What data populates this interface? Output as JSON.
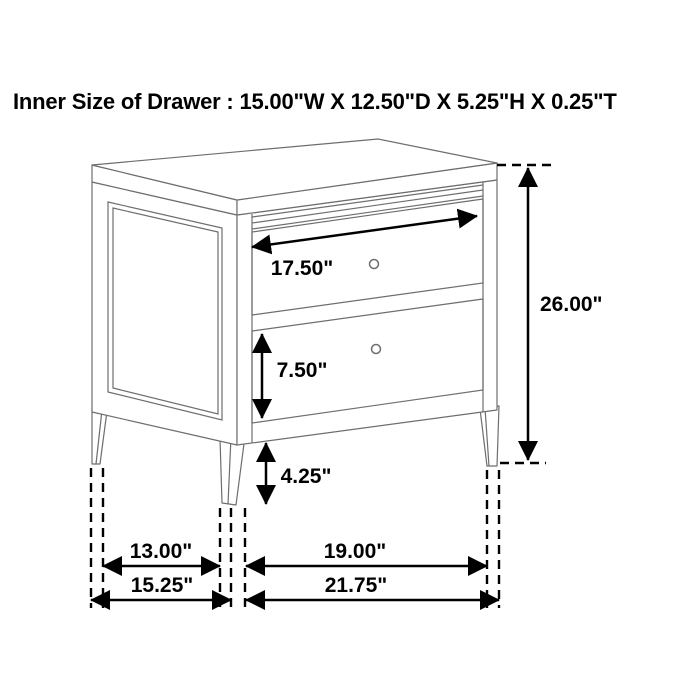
{
  "title": "Inner Size of Drawer : 15.00\"W X 12.50\"D X 5.25\"H X 0.25\"T",
  "dimensions": {
    "drawer_front_width": "17.50\"",
    "overall_height": "26.00\"",
    "bottom_drawer_height": "7.50\"",
    "leg_height": "4.25\"",
    "side_leg_span_inner": "13.00\"",
    "side_overall_depth": "15.25\"",
    "front_leg_span_inner": "19.00\"",
    "front_overall_width": "21.75\""
  },
  "colors": {
    "background": "#ffffff",
    "furniture_line": "#6e6e6e",
    "dimension_line": "#000000",
    "text": "#000000"
  }
}
